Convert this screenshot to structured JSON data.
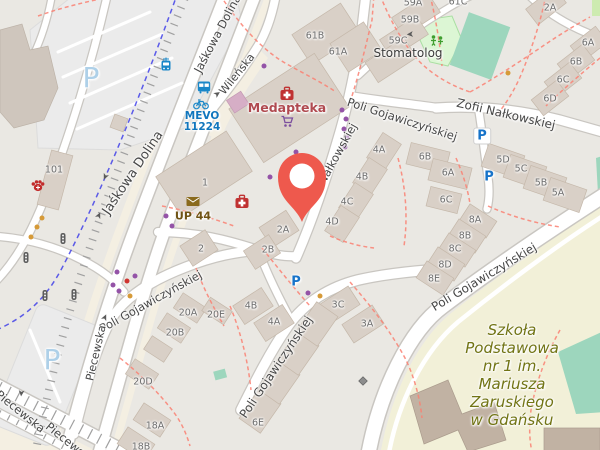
{
  "colors": {
    "background": "#eae8e3",
    "building": "#d9d0c7",
    "building_stroke": "#c5b8aa",
    "building_dark": "#cfc6bd",
    "school_building": "#c1b2a3",
    "road_fill": "#ffffff",
    "road_casing": "#c9c6c1",
    "cream": "#f4efe2",
    "parking_lot": "#ebebeb",
    "parking_lot_stroke": "#dcdcdc",
    "footpath_red": "#fa8072",
    "cycleway_blue": "#2b2be8",
    "tram_grey": "#a0a0a0",
    "pitch_green": "#9dd6bd",
    "playground_green": "#dcf6d4",
    "playground_stroke": "#a9dfa2",
    "grass_green": "#cdebb0",
    "school_ground": "#f2f0d8",
    "pin_red": "#ee594d",
    "street_text": "#474747",
    "housenumber_text": "#6c6c6c",
    "pharmacy_red": "#c03232",
    "medapteka_text": "#b04a50",
    "shop_purple": "#7c4f9e",
    "vet_red": "#c22b2b",
    "post_brown": "#8a6a1c",
    "post_text": "#6f5314",
    "transit_blue": "#1a87c8",
    "mevo_text": "#1176bd",
    "parking_blue": "#1673c9",
    "parking_pale": "#aed0e8",
    "school_text": "#717414",
    "stomatolog_text": "#3c3c3c",
    "dot_purple": "#9453a7",
    "dot_orange": "#d69a38",
    "dot_red": "#cf3430",
    "signal_grey": "#5c5c5c",
    "icon_green": "#3f9e2f",
    "arrow_grey": "#5a5a5a",
    "gate_grey": "#8d8d8d"
  },
  "streets": [
    {
      "text": "Jaśkowa Dolina",
      "x": 218,
      "y": 34,
      "rot": -62,
      "size": 11.5
    },
    {
      "text": "Jaśkowa Dolina",
      "x": 133,
      "y": 173,
      "rot": -56,
      "size": 13
    },
    {
      "text": "Wileńska",
      "x": 237,
      "y": 74,
      "rot": -51,
      "size": 11
    },
    {
      "text": "Poli Gojawiczyńskiej",
      "x": 402,
      "y": 120,
      "rot": 18,
      "size": 11.5
    },
    {
      "text": "Zofii Nałkowskiej",
      "x": 506,
      "y": 114,
      "rot": 13,
      "size": 12
    },
    {
      "text": "Nałkowskiej",
      "x": 338,
      "y": 154,
      "rot": -61,
      "size": 11.5
    },
    {
      "text": "Poli Gojawiczyńskiej",
      "x": 151,
      "y": 302,
      "rot": -29,
      "size": 11.5
    },
    {
      "text": "Poli Gojawiczyńskiej",
      "x": 276,
      "y": 367,
      "rot": -56,
      "size": 12
    },
    {
      "text": "Poli Gojawiczyńskiej",
      "x": 484,
      "y": 277,
      "rot": -31,
      "size": 12
    },
    {
      "text": "Piecewska",
      "x": 96,
      "y": 353,
      "rot": -77,
      "size": 11
    },
    {
      "text": "Piecewska",
      "x": 20,
      "y": 412,
      "rot": 39,
      "size": 11.5
    },
    {
      "text": "Piecewska",
      "x": 70,
      "y": 444,
      "rot": 39,
      "size": 11.5
    }
  ],
  "housenumbers": [
    {
      "text": "61B",
      "x": 315,
      "y": 36
    },
    {
      "text": "61A",
      "x": 338,
      "y": 52
    },
    {
      "text": "59A",
      "x": 413,
      "y": 3
    },
    {
      "text": "61C",
      "x": 458,
      "y": 2
    },
    {
      "text": "59B",
      "x": 410,
      "y": 20
    },
    {
      "text": "59C",
      "x": 398,
      "y": 41
    },
    {
      "text": "2A",
      "x": 550,
      "y": 8
    },
    {
      "text": "6A",
      "x": 588,
      "y": 43
    },
    {
      "text": "6B",
      "x": 576,
      "y": 62
    },
    {
      "text": "6C",
      "x": 563,
      "y": 80
    },
    {
      "text": "6D",
      "x": 550,
      "y": 99
    },
    {
      "text": "6B",
      "x": 425,
      "y": 157
    },
    {
      "text": "6A",
      "x": 448,
      "y": 173
    },
    {
      "text": "6C",
      "x": 446,
      "y": 200
    },
    {
      "text": "5D",
      "x": 503,
      "y": 160
    },
    {
      "text": "5C",
      "x": 521,
      "y": 169
    },
    {
      "text": "5B",
      "x": 541,
      "y": 183
    },
    {
      "text": "5A",
      "x": 558,
      "y": 193
    },
    {
      "text": "8A",
      "x": 475,
      "y": 220
    },
    {
      "text": "8B",
      "x": 465,
      "y": 236
    },
    {
      "text": "8C",
      "x": 455,
      "y": 249
    },
    {
      "text": "8D",
      "x": 445,
      "y": 265
    },
    {
      "text": "8E",
      "x": 434,
      "y": 279
    },
    {
      "text": "4A",
      "x": 379,
      "y": 150
    },
    {
      "text": "4B",
      "x": 362,
      "y": 177
    },
    {
      "text": "4C",
      "x": 347,
      "y": 202
    },
    {
      "text": "4D",
      "x": 332,
      "y": 222
    },
    {
      "text": "2A",
      "x": 283,
      "y": 230
    },
    {
      "text": "2B",
      "x": 268,
      "y": 250
    },
    {
      "text": "2",
      "x": 201,
      "y": 249
    },
    {
      "text": "1",
      "x": 205,
      "y": 183
    },
    {
      "text": "101",
      "x": 54,
      "y": 170
    },
    {
      "text": "20A",
      "x": 188,
      "y": 313
    },
    {
      "text": "20E",
      "x": 216,
      "y": 315
    },
    {
      "text": "20B",
      "x": 175,
      "y": 333
    },
    {
      "text": "20D",
      "x": 143,
      "y": 382
    },
    {
      "text": "18A",
      "x": 155,
      "y": 426
    },
    {
      "text": "18B",
      "x": 141,
      "y": 447
    },
    {
      "text": "4B",
      "x": 251,
      "y": 306
    },
    {
      "text": "4A",
      "x": 274,
      "y": 322
    },
    {
      "text": "3C",
      "x": 338,
      "y": 305
    },
    {
      "text": "3A",
      "x": 367,
      "y": 324
    },
    {
      "text": "6E",
      "x": 258,
      "y": 423
    }
  ],
  "places": {
    "medapteka": {
      "text": "Medapteka",
      "x": 287,
      "y": 108
    },
    "stomatolog": {
      "text": "Stomatolog",
      "x": 408,
      "y": 53
    },
    "up44": {
      "text": "UP 44",
      "x": 193,
      "y": 216
    },
    "mevo": {
      "lines": [
        "MEVO",
        "11224"
      ],
      "x": 202,
      "y": 122
    },
    "school": {
      "lines": [
        "Szkoła",
        "Podstawowa",
        "nr 1 im.",
        "Mariusza",
        "Zaruskiego",
        "w Gdańsku"
      ],
      "x": 512,
      "y": 375
    }
  },
  "parking_area_labels": [
    {
      "text": "P",
      "x": 91,
      "y": 78
    },
    {
      "text": "P",
      "x": 52,
      "y": 360
    }
  ],
  "parking_signs": [
    {
      "text": "P",
      "x": 482,
      "y": 136,
      "pill": true
    },
    {
      "text": "P",
      "x": 489,
      "y": 177,
      "pill": false
    },
    {
      "text": "P",
      "x": 296,
      "y": 282,
      "pill": false
    }
  ],
  "pois": [
    {
      "type": "pharmacy",
      "x": 287,
      "y": 95
    },
    {
      "type": "pharmacy",
      "x": 242,
      "y": 203
    },
    {
      "type": "supermarket-cart",
      "x": 287,
      "y": 122
    },
    {
      "type": "veterinary-paw",
      "x": 38,
      "y": 187
    },
    {
      "type": "post-envelope",
      "x": 193,
      "y": 201
    },
    {
      "type": "tram-stop",
      "x": 166,
      "y": 66
    },
    {
      "type": "bus-stop",
      "x": 204,
      "y": 88
    },
    {
      "type": "bike-share",
      "x": 201,
      "y": 104
    },
    {
      "type": "playground",
      "x": 437,
      "y": 41
    },
    {
      "type": "gate",
      "x": 363,
      "y": 381
    },
    {
      "type": "traffic-signal",
      "x": 63,
      "y": 239
    },
    {
      "type": "traffic-signal",
      "x": 26,
      "y": 258
    },
    {
      "type": "traffic-signal",
      "x": 45,
      "y": 296
    },
    {
      "type": "traffic-signal",
      "x": 74,
      "y": 295
    }
  ],
  "dots": [
    {
      "color": "purple",
      "x": 264,
      "y": 66
    },
    {
      "color": "purple",
      "x": 342,
      "y": 110
    },
    {
      "color": "purple",
      "x": 346,
      "y": 119
    },
    {
      "color": "purple",
      "x": 344,
      "y": 129
    },
    {
      "color": "purple",
      "x": 347,
      "y": 138
    },
    {
      "color": "purple",
      "x": 345,
      "y": 147
    },
    {
      "color": "purple",
      "x": 296,
      "y": 152
    },
    {
      "color": "purple",
      "x": 270,
      "y": 177
    },
    {
      "color": "purple",
      "x": 166,
      "y": 216
    },
    {
      "color": "purple",
      "x": 172,
      "y": 226
    },
    {
      "color": "purple",
      "x": 117,
      "y": 272
    },
    {
      "color": "purple",
      "x": 113,
      "y": 285
    },
    {
      "color": "purple",
      "x": 135,
      "y": 276
    },
    {
      "color": "purple",
      "x": 119,
      "y": 291
    },
    {
      "color": "purple",
      "x": 308,
      "y": 293
    },
    {
      "color": "orange",
      "x": 42,
      "y": 218
    },
    {
      "color": "orange",
      "x": 37,
      "y": 227
    },
    {
      "color": "orange",
      "x": 31,
      "y": 237
    },
    {
      "color": "orange",
      "x": 508,
      "y": 73
    },
    {
      "color": "orange",
      "x": 130,
      "y": 296
    },
    {
      "color": "orange",
      "x": 320,
      "y": 296
    },
    {
      "color": "red",
      "x": 127,
      "y": 281
    }
  ],
  "oneway_arrows": [
    {
      "x": 104,
      "y": 176,
      "rot": 115
    },
    {
      "x": 100,
      "y": 216,
      "rot": -65
    },
    {
      "x": 218,
      "y": 95,
      "rot": -35
    },
    {
      "x": 410,
      "y": 33,
      "rot": 175
    },
    {
      "x": 20,
      "y": 393,
      "rot": 95
    },
    {
      "x": 106,
      "y": 318,
      "rot": -65
    }
  ],
  "marker": {
    "x": 302,
    "y": 183
  }
}
